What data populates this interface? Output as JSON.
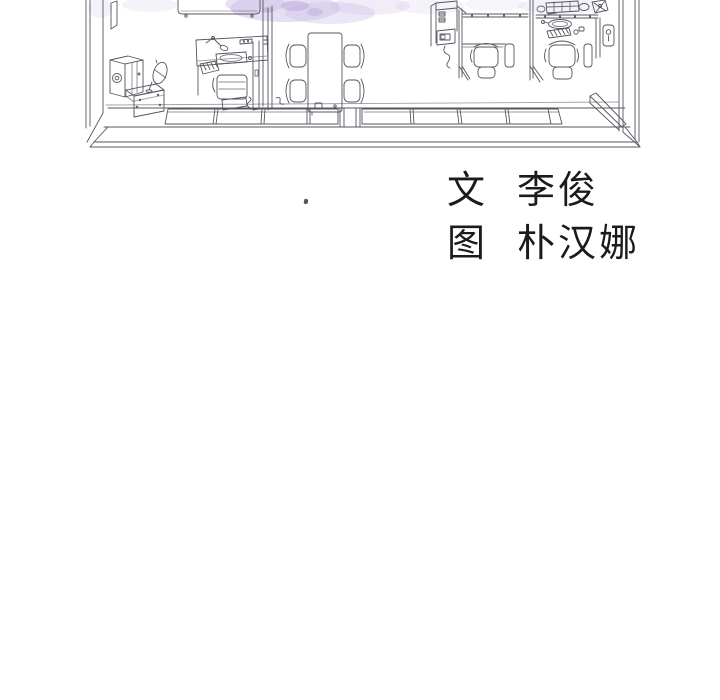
{
  "colors": {
    "line": "#56565f",
    "ink": "#1b1b1b",
    "background": "#ffffff",
    "watercolor_wash": "#cdbfe7",
    "watercolor_wash_dark": "#b4a0da",
    "purple_outline": "#7d5fb0",
    "purple_fill": "#c9aee6",
    "dark_object": "#45454d"
  },
  "credits": {
    "lines": [
      {
        "role": "文",
        "name": "李俊"
      },
      {
        "role": "图",
        "name": "朴汉娜"
      }
    ]
  }
}
